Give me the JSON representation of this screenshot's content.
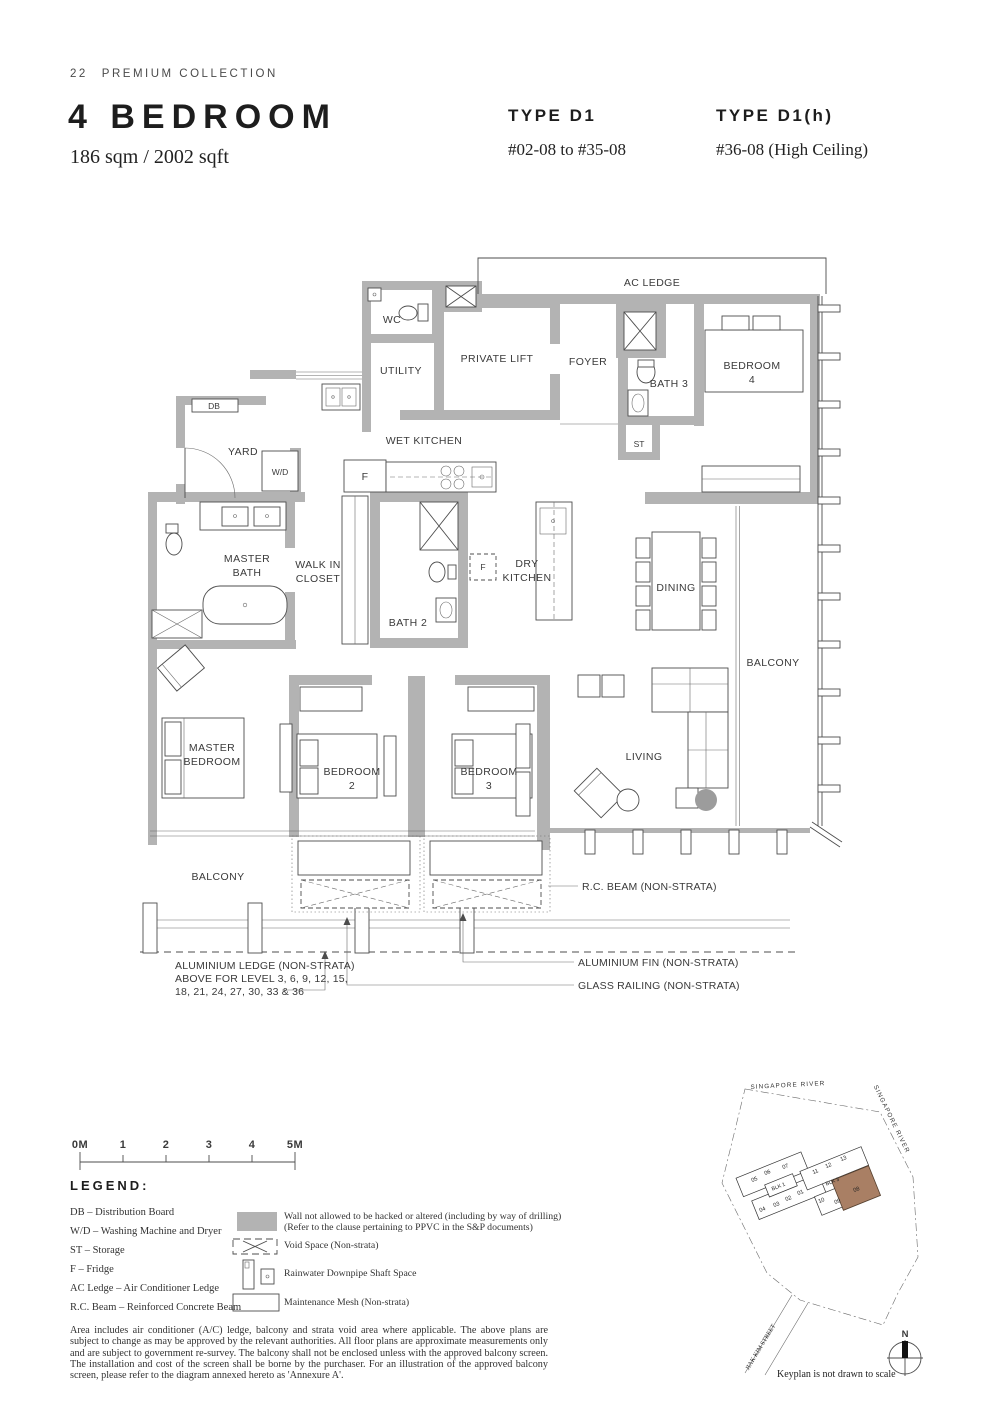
{
  "page": {
    "number": "22",
    "collection": "PREMIUM COLLECTION"
  },
  "header": {
    "title": "4 BEDROOM",
    "area": "186 sqm / 2002 sqft",
    "types": [
      {
        "name": "TYPE D1",
        "units": "#02-08 to #35-08"
      },
      {
        "name": "TYPE D1(h)",
        "units": "#36-08 (High Ceiling)"
      }
    ]
  },
  "plan": {
    "labels": {
      "ac_ledge": "AC LEDGE",
      "wc": "WC",
      "private_lift": "PRIVATE LIFT",
      "foyer": "FOYER",
      "bath3": "BATH 3",
      "bedroom4_1": "BEDROOM",
      "bedroom4_2": "4",
      "st": "ST",
      "utility": "UTILITY",
      "wet_kitchen": "WET KITCHEN",
      "db": "DB",
      "yard": "YARD",
      "wd": "W/D",
      "fridge": "F",
      "fridge2": "F",
      "master_bath_1": "MASTER",
      "master_bath_2": "BATH",
      "walk_in_1": "WALK IN",
      "walk_in_2": "CLOSET",
      "bath2": "BATH 2",
      "dry_1": "DRY",
      "dry_2": "KITCHEN",
      "dining": "DINING",
      "balcony_right": "BALCONY",
      "master_bed_1": "MASTER",
      "master_bed_2": "BEDROOM",
      "bedroom2_1": "BEDROOM",
      "bedroom2_2": "2",
      "bedroom3_1": "BEDROOM",
      "bedroom3_2": "3",
      "living": "LIVING",
      "balcony_bottom": "BALCONY"
    },
    "annotations": {
      "rc_beam": "R.C. BEAM (NON-STRATA)",
      "alum_ledge_1": "ALUMINIUM LEDGE (NON-STRATA)",
      "alum_ledge_2": "ABOVE FOR LEVEL 3, 6, 9, 12, 15,",
      "alum_ledge_3": "18, 21, 24, 27, 30, 33 & 36",
      "alum_fin": "ALUMINIUM FIN (NON-STRATA)",
      "glass_railing": "GLASS RAILING (NON-STRATA)"
    }
  },
  "scalebar": {
    "labels": [
      "0M",
      "1",
      "2",
      "3",
      "4",
      "5M"
    ]
  },
  "legend": {
    "title": "LEGEND:",
    "abbr": [
      "DB – Distribution Board",
      "W/D – Washing Machine and Dryer",
      "ST – Storage",
      "F – Fridge",
      "AC Ledge – Air Conditioner Ledge",
      "R.C. Beam – Reinforced Concrete Beam"
    ],
    "symbols": {
      "wall_1": "Wall not allowed to be hacked or altered (including by way of drilling)",
      "wall_2": "(Refer to the clause pertaining to PPVC in the S&P documents)",
      "void": "Void Space (Non-strata)",
      "rainwater": "Rainwater Downpipe Shaft Space",
      "mesh": "Maintenance Mesh (Non-strata)"
    }
  },
  "disclaimer": "Area includes air conditioner (A/C) ledge, balcony and strata void area where applicable. The above plans are subject to change as may be approved by the relevant authorities. All floor plans are approximate measurements only and are subject to government re-survey. The balcony shall not be enclosed unless with the approved balcony screen. The installation and cost of the screen shall be borne by the purchaser. For an illustration of the approved balcony screen, please refer to the diagram annexed hereto as 'Annexure A'.",
  "keyplan": {
    "river_top": "SINGAPORE RIVER",
    "river_right": "SINGAPORE RIVER",
    "street": "JIAK KIM STREET",
    "note": "Keyplan is not drawn to scale",
    "north": "N",
    "blk1": {
      "label": "BLK 1",
      "units": [
        "05",
        "06",
        "07",
        "04",
        "03",
        "02",
        "01"
      ]
    },
    "blk3": {
      "label": "BLK 3",
      "units": [
        "11",
        "12",
        "13",
        "10",
        "09",
        "08"
      ]
    },
    "highlighted_unit": "08"
  },
  "colors": {
    "wall": "#b3b3b3",
    "keyplan_highlight": "#a97f64"
  }
}
